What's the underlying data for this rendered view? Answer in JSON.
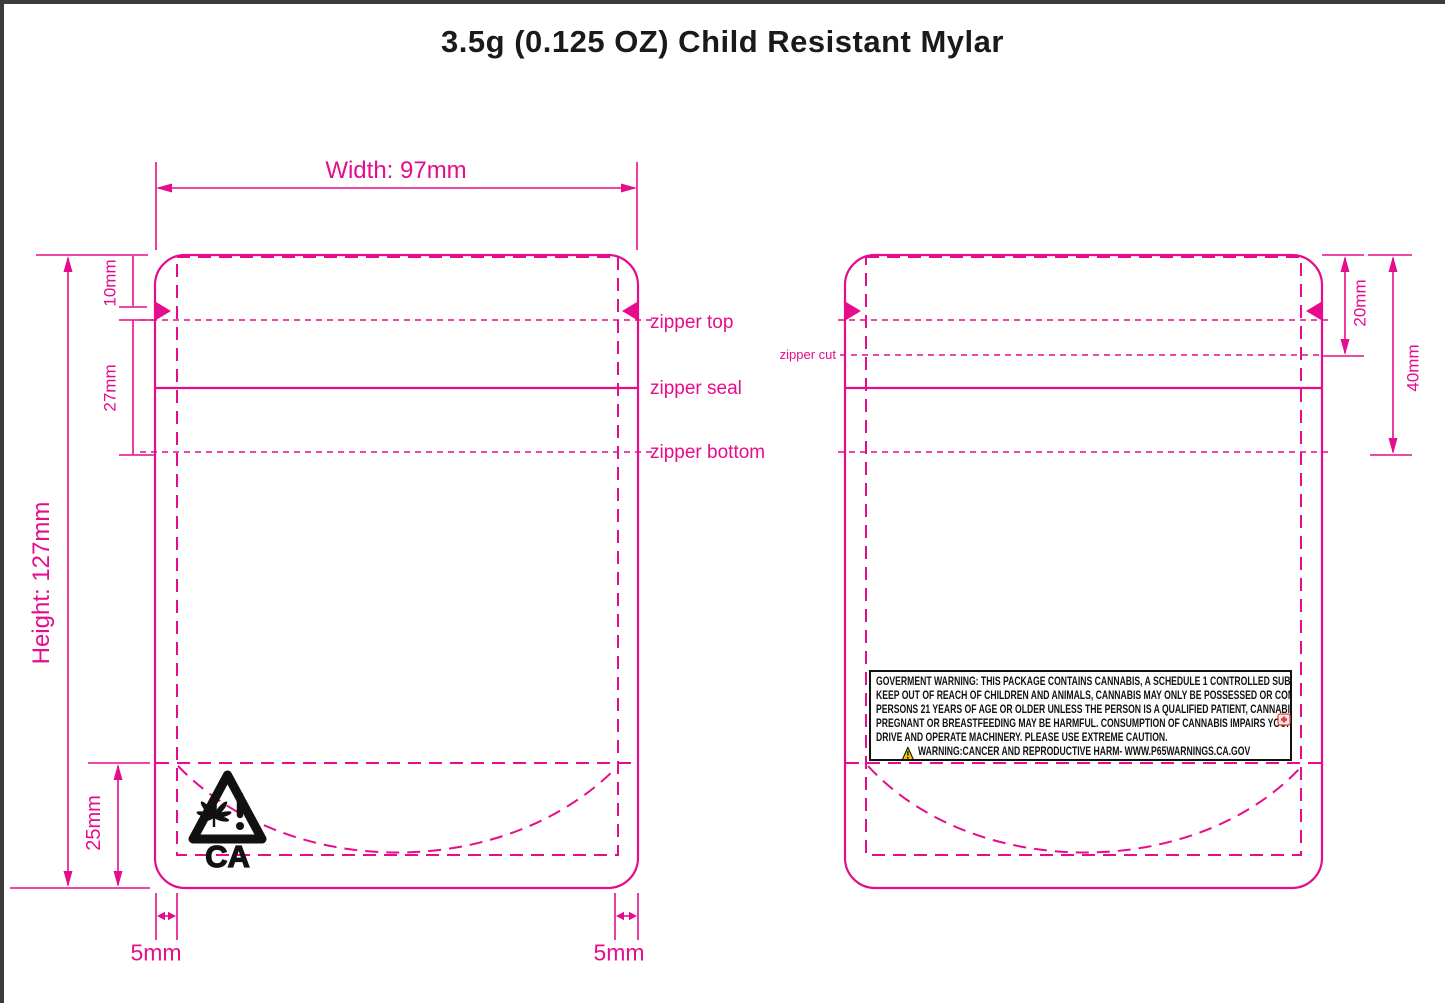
{
  "title": "3.5g (0.125 OZ) Child Resistant Mylar",
  "colors": {
    "accent": "#E60C8C",
    "ink": "#1A1A1A",
    "frame": "#3B3B3B",
    "warning_yellow": "#F6C700",
    "alert_red": "#E04040"
  },
  "dimensions": {
    "width": "Width: 97mm",
    "height": "Height: 127mm",
    "tear_notch": "10mm",
    "zipper_span": "27mm",
    "bottom_gusset": "25mm",
    "seal_left": "5mm",
    "seal_right": "5mm",
    "zipper_cut_depth": "20mm",
    "zipper_area": "40mm"
  },
  "zipper": {
    "top": "zipper top",
    "seal": "zipper seal",
    "bottom": "zipper bottom",
    "cut": "zipper cut"
  },
  "compliance": {
    "ca_symbol": "CA",
    "government_warning_lines": [
      "GOVERMENT WARNING: THIS PACKAGE CONTAINS CANNABIS, A SCHEDULE 1 CONTROLLED SUBSTANCE.",
      "KEEP OUT OF REACH OF CHILDREN AND ANIMALS, CANNABIS MAY ONLY BE POSSESSED OR CONSUMED BY",
      "PERSONS 21 YEARS OF AGE OR OLDER UNLESS THE PERSON IS A QUALIFIED PATIENT, CANNABIS USE WHILE",
      "PREGNANT OR BREASTFEEDING MAY BE HARMFUL. CONSUMPTION OF CANNABIS IMPAIRS YOUR ABILITY TO",
      "DRIVE AND OPERATE MACHINERY. PLEASE USE EXTREME CAUTION.",
      "WARNING:CANCER AND REPRODUCTIVE HARM- WWW.P65WARNINGS.CA.GOV"
    ]
  }
}
